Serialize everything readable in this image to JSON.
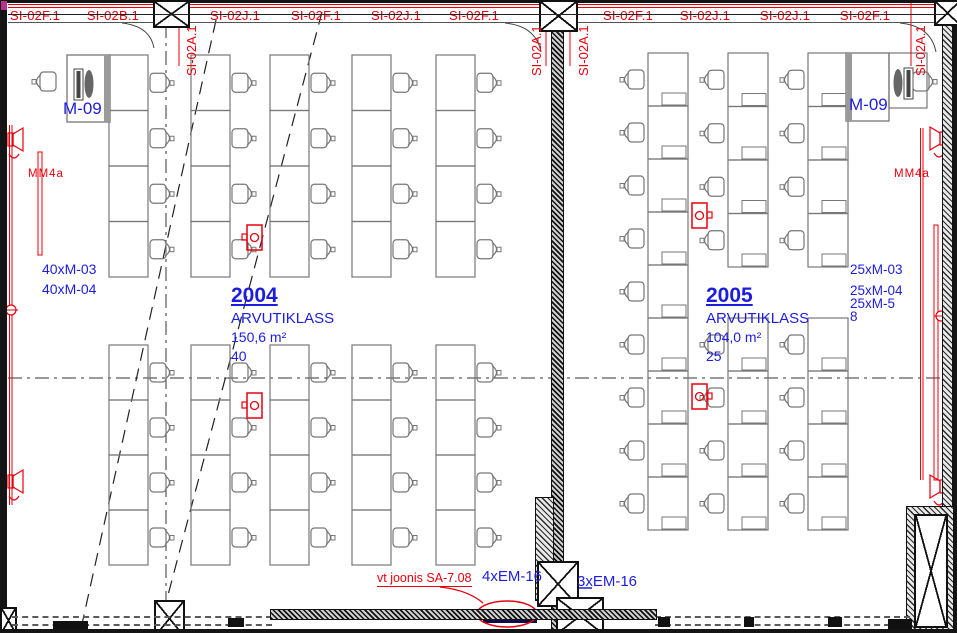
{
  "colors": {
    "red": "#e8000d",
    "blue": "#1d1de0",
    "furniture": "#777777",
    "wall": "#141414"
  },
  "top_labels": {
    "horizontal": [
      {
        "text": "SI-02F.1",
        "x": 35
      },
      {
        "text": "SI-02B.1",
        "x": 113
      },
      {
        "text": "SI-02J.1",
        "x": 235
      },
      {
        "text": "SI-02F.1",
        "x": 316
      },
      {
        "text": "SI-02J.1",
        "x": 396
      },
      {
        "text": "SI-02F.1",
        "x": 474
      },
      {
        "text": "SI-02F.1",
        "x": 628
      },
      {
        "text": "SI-02J.1",
        "x": 705
      },
      {
        "text": "SI-02J.1",
        "x": 785
      },
      {
        "text": "SI-02F.1",
        "x": 865
      }
    ],
    "vertical": [
      {
        "text": "SI-02A.1",
        "x": 184
      },
      {
        "text": "SI-02A.1",
        "x": 529
      },
      {
        "text": "SI-02A.1",
        "x": 576
      },
      {
        "text": "SI-02A.1",
        "x": 913
      }
    ]
  },
  "rooms": [
    {
      "number": "2004",
      "type": "ARVUTIKLASS",
      "area": "150,6 m²",
      "seats": "40",
      "teacher_station": "M-09",
      "equipment": [
        "40xM-03",
        "40xM-04"
      ]
    },
    {
      "number": "2005",
      "type": "ARVUTIKLASS",
      "area": "104,0 m²",
      "seats": "25",
      "teacher_station": "M-09",
      "equipment": [
        "25xM-03",
        "25xM-04",
        "25xM-5",
        "8"
      ]
    }
  ],
  "wall_labels": {
    "left": "MM4a",
    "right": "MM4a"
  },
  "notes": {
    "red_note": "vt joonis SA-7.08",
    "blue_note_center": "4xEM-16",
    "blue_note_right": "3xEM-16"
  },
  "furniture": {
    "rooms": [
      {
        "key": "room-2004",
        "desk_w": 39,
        "chair_dir": "right",
        "inner": false,
        "cols": [
          {
            "x": 109,
            "stacks": [
              [
                55,
                4,
                55.5
              ],
              [
                345,
                4,
                55
              ]
            ]
          },
          {
            "x": 191,
            "stacks": [
              [
                55,
                4,
                55.5
              ],
              [
                345,
                4,
                55
              ]
            ]
          },
          {
            "x": 270,
            "stacks": [
              [
                55,
                4,
                55.5
              ],
              [
                345,
                4,
                55
              ]
            ]
          },
          {
            "x": 352,
            "stacks": [
              [
                55,
                4,
                55.5
              ],
              [
                345,
                4,
                55
              ]
            ]
          },
          {
            "x": 436,
            "stacks": [
              [
                55,
                4,
                55.5
              ],
              [
                345,
                4,
                55
              ]
            ]
          }
        ]
      },
      {
        "key": "room-2005",
        "desk_w": 40,
        "chair_dir": "left",
        "inner": true,
        "cols": [
          {
            "x": 648,
            "stacks": [
              [
                53,
                9,
                53
              ]
            ]
          },
          {
            "x": 728,
            "stacks": [
              [
                53,
                4,
                53.5
              ],
              [
                318,
                4,
                53
              ]
            ]
          },
          {
            "x": 808,
            "stacks": [
              [
                53,
                4,
                53.5
              ],
              [
                318,
                4,
                53
              ]
            ]
          }
        ]
      }
    ],
    "outlets": [
      {
        "x": 247,
        "y": 225,
        "stub": "left"
      },
      {
        "x": 247,
        "y": 393,
        "stub": "left"
      },
      {
        "x": 692,
        "y": 203,
        "stub": "right"
      },
      {
        "x": 692,
        "y": 384,
        "stub": "right"
      }
    ]
  }
}
